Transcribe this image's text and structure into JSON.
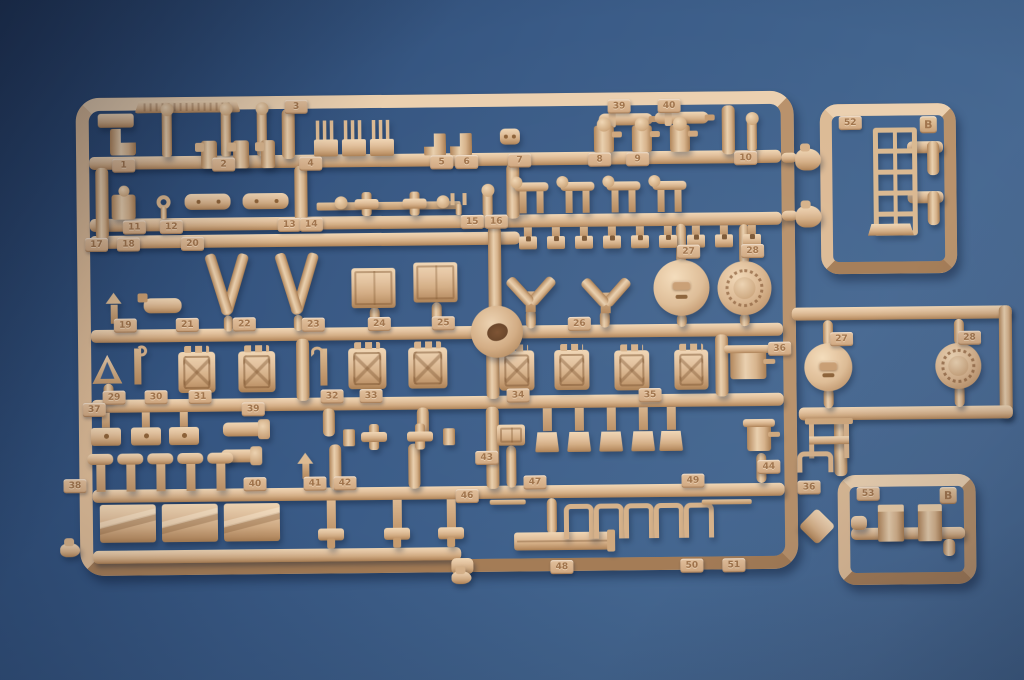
{
  "scene": {
    "w": 1024,
    "h": 680,
    "alt": "Photograph of a tan plastic model kit sprue (parts tree) with numbered parts on a blue background"
  },
  "palette": {
    "background_blue": "#3a5b87",
    "plastic_base": "#d3ac84",
    "plastic_highlight": "#f0d6b4",
    "plastic_shadow": "#a97e52",
    "tag_text": "#a0744c"
  },
  "main_sprue": {
    "frame": {
      "x": 78,
      "y": 98,
      "w": 718,
      "h": 478
    },
    "rails": [
      [
        91,
        157,
        692,
        13
      ],
      [
        91,
        219,
        692,
        13
      ],
      [
        91,
        236,
        430,
        13
      ],
      [
        91,
        330,
        692,
        13
      ],
      [
        91,
        400,
        692,
        13
      ],
      [
        91,
        490,
        692,
        13
      ],
      [
        91,
        551,
        368,
        13
      ],
      [
        284,
        111,
        13,
        50
      ],
      [
        724,
        112,
        13,
        49
      ],
      [
        296,
        168,
        13,
        55
      ],
      [
        508,
        168,
        13,
        55
      ],
      [
        97,
        168,
        13,
        72
      ],
      [
        489,
        230,
        13,
        103
      ],
      [
        486,
        341,
        13,
        62
      ],
      [
        485,
        411,
        13,
        82
      ],
      [
        296,
        341,
        13,
        62
      ],
      [
        715,
        341,
        13,
        62
      ],
      [
        677,
        230,
        10,
        40
      ],
      [
        677,
        320,
        10,
        13
      ],
      [
        740,
        231,
        10,
        40
      ],
      [
        740,
        320,
        10,
        13
      ],
      [
        526,
        314,
        10,
        19
      ],
      [
        600,
        316,
        10,
        17
      ],
      [
        370,
        310,
        10,
        22
      ],
      [
        432,
        306,
        10,
        26
      ],
      [
        224,
        317,
        9,
        16
      ],
      [
        294,
        317,
        9,
        16
      ],
      [
        103,
        384,
        10,
        18
      ],
      [
        322,
        411,
        12,
        28
      ],
      [
        416,
        411,
        12,
        28
      ],
      [
        328,
        447,
        12,
        45
      ],
      [
        407,
        447,
        12,
        45
      ],
      [
        505,
        450,
        10,
        42
      ],
      [
        545,
        503,
        10,
        36
      ],
      [
        449,
        562,
        22,
        16
      ],
      [
        755,
        460,
        10,
        30
      ]
    ],
    "parts": [
      [
        "emboss-strip",
        137,
        102,
        106,
        12
      ],
      [
        "tab",
        100,
        114,
        36,
        14
      ],
      [
        "bracket",
        112,
        129,
        26,
        27
      ],
      [
        "pin",
        164,
        111,
        10,
        47
      ],
      [
        "pin",
        223,
        111,
        10,
        47
      ],
      [
        "pin",
        259,
        111,
        10,
        47
      ],
      [
        "hookpin",
        203,
        142,
        16,
        28
      ],
      [
        "hookpin",
        235,
        142,
        16,
        28
      ],
      [
        "hookpin",
        263,
        142,
        14,
        28
      ],
      [
        "comb",
        316,
        123,
        24,
        36
      ],
      [
        "comb",
        344,
        123,
        24,
        36
      ],
      [
        "comb",
        372,
        123,
        24,
        36
      ],
      [
        "boot",
        426,
        137,
        22,
        22
      ],
      [
        "boot",
        452,
        137,
        22,
        22
      ],
      [
        "eyelet",
        502,
        133,
        20,
        16
      ],
      [
        "barrel",
        601,
        119,
        54,
        12
      ],
      [
        "barrel",
        657,
        118,
        54,
        12
      ],
      [
        "periscope",
        596,
        131,
        20,
        27
      ],
      [
        "periscope",
        634,
        131,
        20,
        27
      ],
      [
        "periscope",
        672,
        131,
        20,
        27
      ],
      [
        "pin",
        749,
        126,
        10,
        32
      ],
      [
        "figure",
        113,
        195,
        24,
        25
      ],
      [
        "ringpin",
        158,
        196,
        14,
        24
      ],
      [
        "plate",
        186,
        195,
        46,
        16
      ],
      [
        "plate",
        244,
        195,
        46,
        16
      ],
      [
        "thinrod",
        318,
        205,
        144,
        8
      ],
      [
        "cross",
        356,
        195,
        24,
        24
      ],
      [
        "cross",
        404,
        195,
        24,
        24
      ],
      [
        "knob",
        336,
        199,
        13,
        13
      ],
      [
        "knob",
        438,
        199,
        13,
        13
      ],
      [
        "fork",
        452,
        197,
        16,
        22
      ],
      [
        "pin",
        484,
        195,
        10,
        25
      ],
      [
        "armpart",
        516,
        187,
        34,
        31
      ],
      [
        "armpart",
        562,
        187,
        34,
        31
      ],
      [
        "armpart",
        608,
        187,
        34,
        31
      ],
      [
        "armpart",
        654,
        187,
        34,
        31
      ],
      [
        "bracket-sq",
        520,
        232,
        18,
        22
      ],
      [
        "bracket-sq",
        548,
        232,
        18,
        22
      ],
      [
        "bracket-sq",
        576,
        232,
        18,
        22
      ],
      [
        "bracket-sq",
        604,
        232,
        18,
        22
      ],
      [
        "bracket-sq",
        632,
        232,
        18,
        22
      ],
      [
        "bracket-sq",
        660,
        232,
        18,
        22
      ],
      [
        "bracket-sq",
        688,
        232,
        18,
        22
      ],
      [
        "bracket-sq",
        716,
        232,
        18,
        22
      ],
      [
        "bracket-sq",
        744,
        232,
        18,
        22
      ],
      [
        "arrowpin",
        106,
        293,
        16,
        31
      ],
      [
        "extinguisher",
        144,
        299,
        38,
        15
      ],
      [
        "vee",
        204,
        252,
        46,
        66
      ],
      [
        "vee",
        274,
        252,
        46,
        66
      ],
      [
        "crate",
        352,
        271,
        44,
        40
      ],
      [
        "crate",
        414,
        266,
        44,
        40
      ],
      [
        "wform",
        502,
        271,
        58,
        46
      ],
      [
        "wform",
        576,
        273,
        60,
        46
      ],
      [
        "hatch-plain",
        654,
        266,
        56,
        56
      ],
      [
        "hatch-ring",
        718,
        268,
        54,
        54
      ],
      [
        "triangle",
        92,
        355,
        30,
        29
      ],
      [
        "rodhook",
        130,
        349,
        14,
        36
      ],
      [
        "jerrycan",
        178,
        353,
        37,
        41
      ],
      [
        "jerrycan",
        238,
        353,
        37,
        41
      ],
      [
        "hookpart",
        315,
        351,
        16,
        37
      ],
      [
        "jerrycan",
        348,
        351,
        38,
        41
      ],
      [
        "jerrycan",
        408,
        351,
        39,
        41
      ],
      [
        "jerrycan",
        499,
        355,
        35,
        40
      ],
      [
        "jerrycan",
        554,
        355,
        35,
        40
      ],
      [
        "jerrycan",
        614,
        356,
        35,
        40
      ],
      [
        "jerrycan",
        674,
        356,
        34,
        40
      ],
      [
        "valve",
        730,
        354,
        36,
        32
      ],
      [
        "platepin",
        90,
        413,
        30,
        33
      ],
      [
        "platepin",
        130,
        413,
        30,
        33
      ],
      [
        "platepin",
        168,
        413,
        30,
        33
      ],
      [
        "horn",
        222,
        424,
        40,
        14
      ],
      [
        "horn",
        220,
        451,
        34,
        13
      ],
      [
        "cross",
        360,
        427,
        26,
        26
      ],
      [
        "cross",
        406,
        427,
        26,
        26
      ],
      [
        "collar",
        342,
        432,
        12,
        17
      ],
      [
        "collar",
        442,
        432,
        12,
        17
      ],
      [
        "crate",
        496,
        429,
        28,
        21
      ],
      [
        "tee-down",
        534,
        413,
        24,
        44
      ],
      [
        "tee-down",
        566,
        413,
        24,
        44
      ],
      [
        "tee-down",
        598,
        413,
        24,
        44
      ],
      [
        "tee-down",
        630,
        413,
        24,
        44
      ],
      [
        "tee-down",
        658,
        413,
        24,
        44
      ],
      [
        "valve",
        746,
        428,
        24,
        30
      ],
      [
        "hammer",
        86,
        454,
        26,
        38
      ],
      [
        "hammer",
        116,
        454,
        26,
        38
      ],
      [
        "hammer",
        146,
        454,
        26,
        38
      ],
      [
        "hammer",
        176,
        454,
        26,
        38
      ],
      [
        "hammer",
        206,
        454,
        26,
        38
      ],
      [
        "arrowpin",
        296,
        455,
        16,
        26
      ],
      [
        "slantbox",
        98,
        505,
        56,
        38
      ],
      [
        "slantbox",
        160,
        505,
        56,
        38
      ],
      [
        "slantbox",
        222,
        505,
        56,
        38
      ],
      [
        "tee-plumb",
        316,
        503,
        26,
        45
      ],
      [
        "tee-plumb",
        382,
        503,
        26,
        45
      ],
      [
        "tee-plumb",
        436,
        503,
        26,
        45
      ],
      [
        "thinrod",
        488,
        504,
        36,
        5
      ],
      [
        "longbar",
        512,
        537,
        98,
        18
      ],
      [
        "uclipsm",
        562,
        509,
        20,
        30
      ],
      [
        "uclipsm",
        592,
        509,
        20,
        30
      ],
      [
        "uclipsm",
        622,
        509,
        20,
        30
      ],
      [
        "uclipsm",
        652,
        509,
        20,
        30
      ],
      [
        "uclipsm",
        682,
        509,
        20,
        30
      ],
      [
        "thinrod",
        700,
        506,
        50,
        5
      ],
      [
        "nub",
        449,
        575,
        20,
        13
      ],
      [
        "gate",
        471,
        310,
        52,
        52
      ],
      [
        "nub",
        58,
        543,
        20,
        14
      ]
    ],
    "tags": [
      [
        "3",
        287,
        102
      ],
      [
        "39",
        610,
        105
      ],
      [
        "40",
        660,
        105
      ],
      [
        "1",
        114,
        159
      ],
      [
        "2",
        214,
        159
      ],
      [
        "4",
        301,
        159
      ],
      [
        "5",
        432,
        159
      ],
      [
        "6",
        457,
        159
      ],
      [
        "7",
        510,
        158
      ],
      [
        "8",
        590,
        158
      ],
      [
        "9",
        628,
        158
      ],
      [
        "10",
        736,
        158
      ],
      [
        "11",
        124,
        221
      ],
      [
        "12",
        161,
        221
      ],
      [
        "13",
        279,
        220
      ],
      [
        "14",
        301,
        220
      ],
      [
        "15",
        462,
        219
      ],
      [
        "16",
        486,
        219
      ],
      [
        "17",
        86,
        238
      ],
      [
        "18",
        118,
        238
      ],
      [
        "20",
        182,
        238
      ],
      [
        "19",
        114,
        319
      ],
      [
        "21",
        176,
        319
      ],
      [
        "22",
        233,
        319
      ],
      [
        "23",
        302,
        320
      ],
      [
        "24",
        368,
        320
      ],
      [
        "25",
        432,
        320
      ],
      [
        "26",
        568,
        322
      ],
      [
        "27",
        678,
        251
      ],
      [
        "28",
        742,
        251
      ],
      [
        "29",
        102,
        391
      ],
      [
        "30",
        144,
        391
      ],
      [
        "31",
        188,
        391
      ],
      [
        "32",
        320,
        392
      ],
      [
        "33",
        359,
        392
      ],
      [
        "34",
        506,
        393
      ],
      [
        "35",
        638,
        394
      ],
      [
        "37",
        82,
        403
      ],
      [
        "39",
        241,
        404
      ],
      [
        "38",
        62,
        479
      ],
      [
        "40",
        242,
        479
      ],
      [
        "41",
        302,
        479
      ],
      [
        "42",
        332,
        479
      ],
      [
        "43",
        474,
        455
      ],
      [
        "44",
        756,
        467
      ],
      [
        "46",
        454,
        493
      ],
      [
        "47",
        522,
        480
      ],
      [
        "49",
        680,
        480
      ],
      [
        "48",
        548,
        565
      ],
      [
        "50",
        678,
        565
      ],
      [
        "51",
        720,
        565
      ],
      [
        "36",
        768,
        349
      ]
    ]
  },
  "right_assembly": {
    "runners": [
      [
        792,
        315,
        220,
        13
      ],
      [
        999,
        315,
        13,
        113
      ],
      [
        798,
        415,
        214,
        13
      ],
      [
        833,
        427,
        13,
        57
      ],
      [
        823,
        328,
        10,
        26
      ],
      [
        954,
        328,
        10,
        26
      ],
      [
        823,
        396,
        10,
        20
      ],
      [
        954,
        394,
        10,
        22
      ],
      [
        783,
        160,
        16,
        10
      ],
      [
        783,
        218,
        16,
        10
      ]
    ],
    "parts": [
      [
        "nub",
        797,
        156,
        26,
        22
      ],
      [
        "nub",
        797,
        213,
        26,
        22
      ],
      [
        "hatch-plain",
        804,
        351,
        48,
        48
      ],
      [
        "hatch-ring",
        935,
        352,
        46,
        46
      ],
      [
        "clamp",
        808,
        428,
        30,
        38
      ],
      [
        "uclipsm",
        796,
        459,
        26,
        16
      ],
      [
        "diamond",
        802,
        521,
        26,
        26
      ]
    ],
    "tags": [
      [
        "27",
        830,
        340
      ],
      [
        "28",
        958,
        340
      ],
      [
        "36",
        796,
        488
      ]
    ]
  },
  "mini_sprue_top": {
    "frame": {
      "x": 822,
      "y": 112,
      "w": 136,
      "h": 170
    },
    "number": "52",
    "letter": "B",
    "runners": [
      [
        909,
        150,
        36,
        12
      ],
      [
        929,
        150,
        12,
        34
      ],
      [
        909,
        200,
        36,
        12
      ],
      [
        929,
        200,
        12,
        34
      ]
    ],
    "parts": [
      [
        "ladder",
        875,
        136,
        34,
        98
      ],
      [
        "ladderfoot",
        869,
        232,
        46,
        12
      ]
    ]
  },
  "mini_sprue_bottom": {
    "frame": {
      "x": 836,
      "y": 483,
      "w": 138,
      "h": 110
    },
    "number": "53",
    "letter": "B",
    "runners": [
      [
        849,
        536,
        114,
        12
      ],
      [
        849,
        524,
        16,
        14
      ],
      [
        941,
        548,
        12,
        17
      ]
    ],
    "parts": [
      [
        "block",
        876,
        513,
        26,
        37
      ],
      [
        "block",
        916,
        513,
        24,
        37
      ]
    ]
  }
}
